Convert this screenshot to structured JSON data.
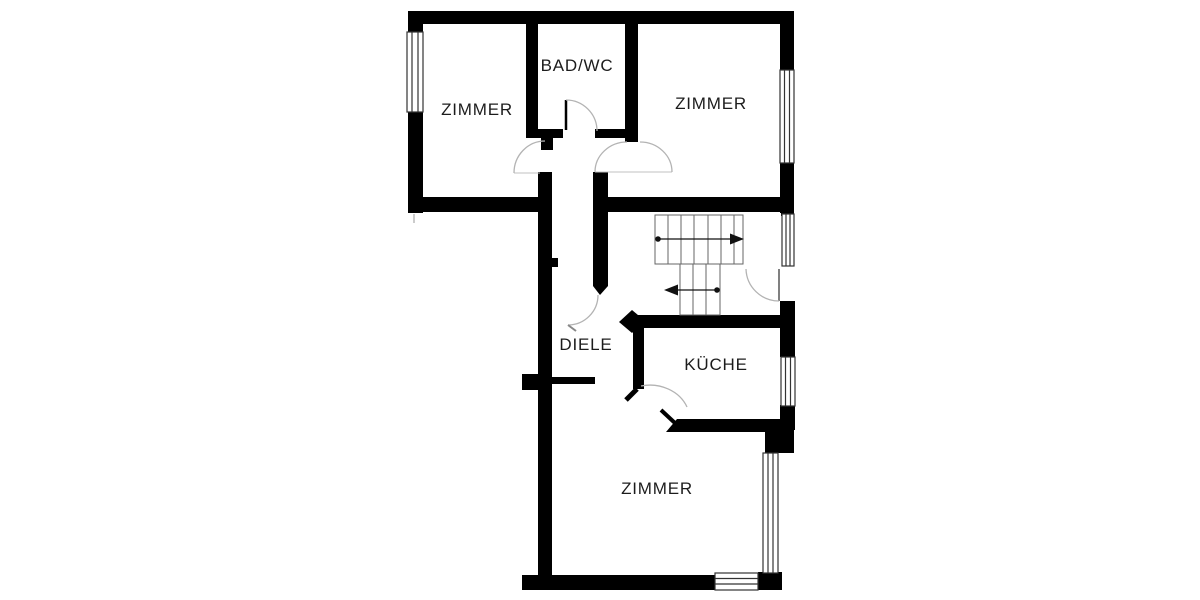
{
  "plan": {
    "type": "apartment-floor-plan",
    "colors": {
      "wall": "#000000",
      "background": "#ffffff",
      "label_text": "#1c1c1c",
      "door_arc": "#b3b3b3",
      "stair_line": "#666666",
      "window_frame": "#333333"
    },
    "rooms": [
      {
        "id": "zimmer-top-left",
        "label": "ZIMMER"
      },
      {
        "id": "bad-wc",
        "label": "BAD/WC"
      },
      {
        "id": "zimmer-top-right",
        "label": "ZIMMER"
      },
      {
        "id": "diele",
        "label": "DIELE"
      },
      {
        "id": "kueche",
        "label": "KÜCHE"
      },
      {
        "id": "zimmer-bottom",
        "label": "ZIMMER"
      }
    ],
    "stairs": {
      "flights": 2,
      "upper_flight_treads": 7,
      "lower_flight_treads": 3,
      "upper_arrow_direction": "right",
      "lower_arrow_direction": "left"
    },
    "window_count": 6,
    "door_count": 7
  }
}
